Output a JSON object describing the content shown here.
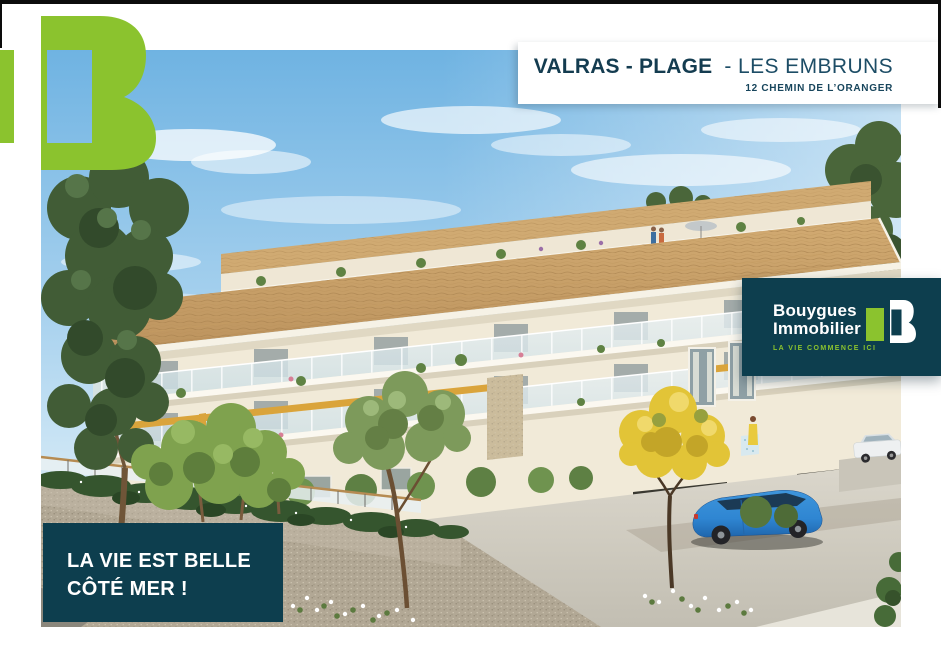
{
  "page": {
    "width": 941,
    "height": 667,
    "background": "#FFFFFF"
  },
  "header": {
    "title_primary": "VALRAS - PLAGE",
    "title_secondary": "- LES EMBRUNS",
    "address": "12 CHEMIN DE L’ORANGER"
  },
  "brand_card": {
    "name_line1": "Bouygues",
    "name_line2": "Immobilier",
    "tagline": "LA VIE COMMENCE ICI"
  },
  "caption": {
    "line1": "LA VIE EST BELLE",
    "line2": "CÔTÉ MER !"
  },
  "logo": {
    "alt": "Bouygues Immobilier B monogram"
  },
  "illustration": {
    "alt": "3D architectural rendering of the Les Embruns residence: three-storey cream building with terracotta tiled roof, planted roof terraces, white glass balconies, ochre accents, stone-clad parking base with a blue car and a white car, pine and olive trees, a yellow flowering tree, ivy-covered wall and white flowers in the foreground under a blue sky"
  },
  "colors": {
    "brand_green": "#8BC32E",
    "brand_teal": "#0D3E4E",
    "title_text": "#143C50",
    "accent_gold": "#D9A43B"
  }
}
